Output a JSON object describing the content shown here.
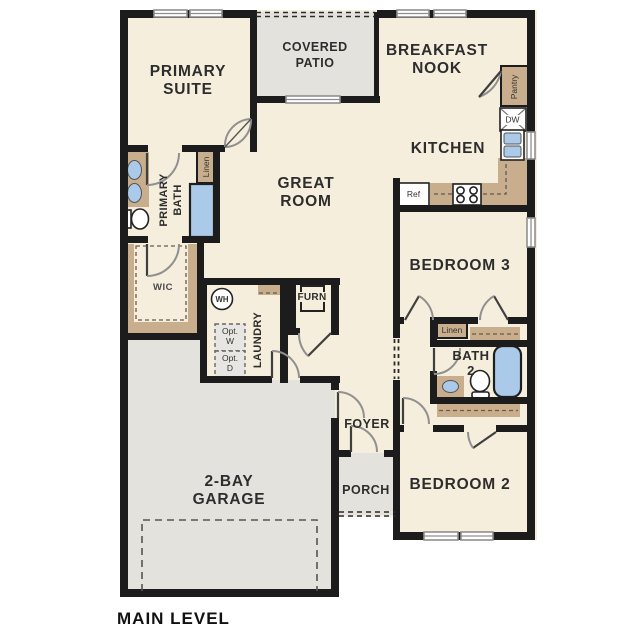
{
  "title": "MAIN LEVEL",
  "colors": {
    "floor": "#f5eedc",
    "outdoor_concrete": "#e3e2dd",
    "cabinetry_tan": "#c8ae8c",
    "plumbing_blue": "#abc9e9",
    "wall_black": "#1c1c1c"
  },
  "rooms": {
    "primary_suite": {
      "line1": "PRIMARY",
      "line2": "SUITE"
    },
    "covered_patio": {
      "line1": "COVERED",
      "line2": "PATIO"
    },
    "breakfast_nook": {
      "line1": "BREAKFAST",
      "line2": "NOOK"
    },
    "kitchen": {
      "line1": "KITCHEN"
    },
    "great_room": {
      "line1": "GREAT",
      "line2": "ROOM"
    },
    "bedroom_3": {
      "line1": "BEDROOM 3"
    },
    "bedroom_2": {
      "line1": "BEDROOM 2"
    },
    "garage": {
      "line1": "2-BAY",
      "line2": "GARAGE"
    },
    "foyer": {
      "line1": "FOYER"
    },
    "porch": {
      "line1": "PORCH"
    },
    "laundry": {
      "line1": "LAUNDRY"
    },
    "primary_bath": {
      "line1": "PRIMARY",
      "line2": "BATH"
    },
    "bath_2": {
      "line1": "BATH",
      "line2": "2"
    },
    "wic": {
      "line1": "WIC"
    },
    "furnace": {
      "line1": "FURN"
    }
  },
  "closets": {
    "pantry": "Pantry",
    "linen_primary": "Linen",
    "linen_hall": "Linen"
  },
  "equipment": {
    "refrigerator": "Ref",
    "dishwasher": "DW",
    "water_heater": "WH",
    "opt_washer_line1": "Opt.",
    "opt_washer_line2": "W",
    "opt_dryer_line1": "Opt.",
    "opt_dryer_line2": "D"
  }
}
